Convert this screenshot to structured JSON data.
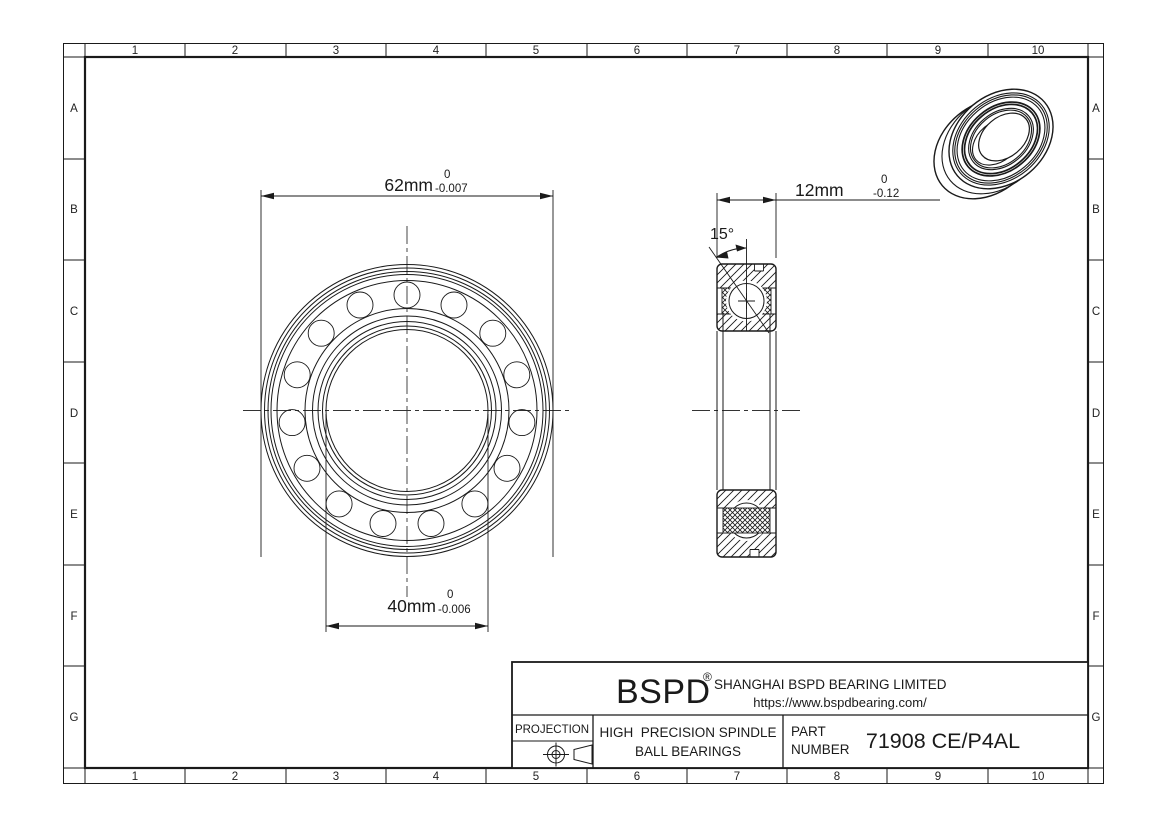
{
  "border": {
    "columns": [
      "1",
      "2",
      "3",
      "4",
      "5",
      "6",
      "7",
      "8",
      "9",
      "10"
    ],
    "rows": [
      "A",
      "B",
      "C",
      "D",
      "E",
      "F",
      "G"
    ]
  },
  "dims": {
    "od": {
      "value": "62mm",
      "tol_top": "0",
      "tol_bottom": "-0.007"
    },
    "bore": {
      "value": "40mm",
      "tol_top": "0",
      "tol_bottom": "-0.006"
    },
    "width": {
      "value": "12mm",
      "tol_top": "0",
      "tol_bottom": "-0.12"
    },
    "angle": "15°"
  },
  "tb": {
    "projection": "PROJECTION",
    "brand": "BSPD",
    "reg": "®",
    "company": "SHANGHAI BSPD BEARING LIMITED",
    "website": "https://www.bspdbearing.com/",
    "product1": "HIGH  PRECISION SPINDLE",
    "product2": "BALL BEARINGS",
    "part1": "PART",
    "part2": "NUMBER",
    "part_number": "71908 CE/P4AL"
  },
  "colors": {
    "line": "#1a1a1a",
    "background": "#ffffff"
  }
}
